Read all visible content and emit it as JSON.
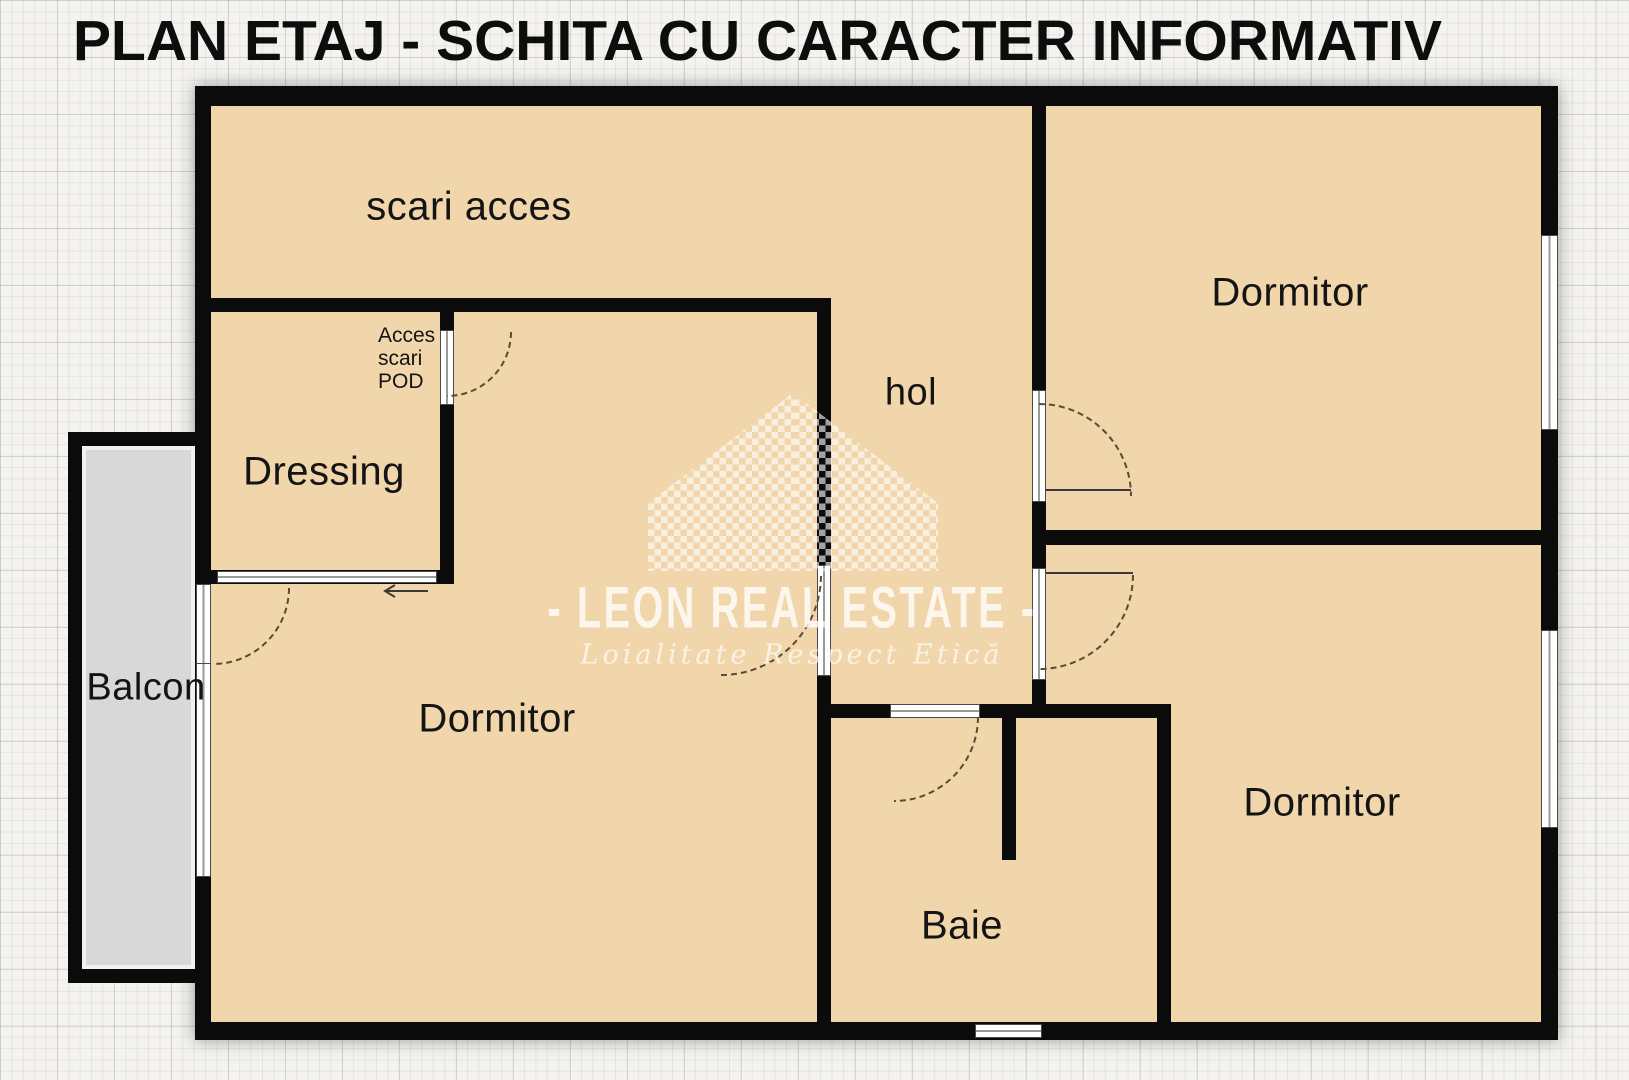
{
  "title": "PLAN ETAJ - SCHITA CU CARACTER INFORMATIV",
  "rooms": {
    "scari_acces": {
      "label": "scari acces"
    },
    "dressing": {
      "label": "Dressing"
    },
    "hol": {
      "label": "hol"
    },
    "dormitor_left": {
      "label": "Dormitor"
    },
    "dormitor_top_right": {
      "label": "Dormitor"
    },
    "dormitor_bottom_right": {
      "label": "Dormitor"
    },
    "baie": {
      "label": "Baie"
    },
    "balcon": {
      "label": "Balcon"
    },
    "acces_scari_pod": {
      "line1": "Acces",
      "line2": "scari",
      "line3": "POD"
    }
  },
  "watermark": {
    "brand": "- LEON REAL ESTATE -",
    "tagline": "Loialitate  Respect  Etică"
  },
  "colors": {
    "wall": "#0b0b0b",
    "room_fill": "#f0d6aa",
    "balcony_fill": "#d8d8d8",
    "paper": "#f4f3ef",
    "arc": "#5e4a33",
    "ink": "#141414"
  }
}
